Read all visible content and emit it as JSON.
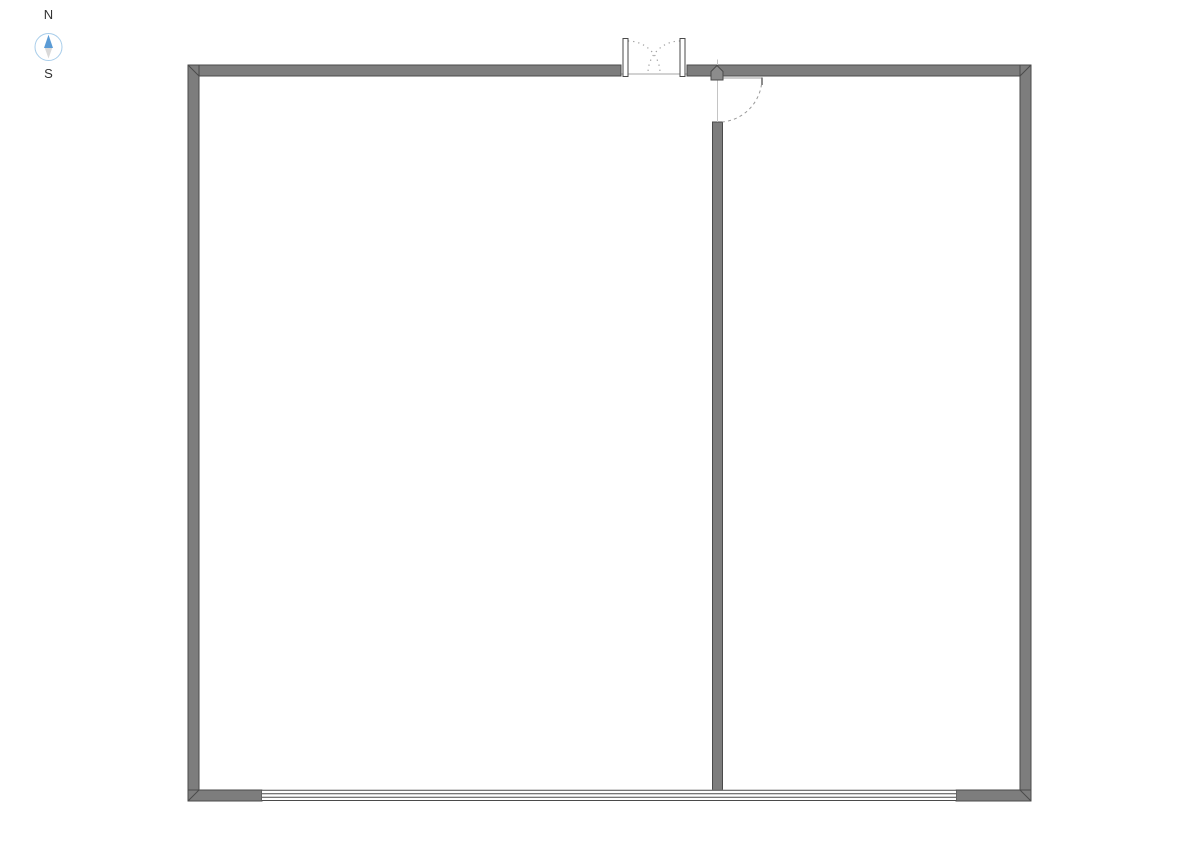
{
  "compass": {
    "north_label": "N",
    "south_label": "S"
  },
  "colors": {
    "background": "#ffffff",
    "wall_fill": "#7d7d7d",
    "wall_outline": "#4a4a4a",
    "window_line": "#4a4a4a",
    "window_fill": "#ffffff",
    "door_panel_fill": "#ffffff",
    "door_swing_dotted": "#9a9a9a",
    "door_leaf_line": "#b0b0b0",
    "threshold_line": "#a6a6a6",
    "hinge_marker_fill": "#8c8c8c",
    "door_tick": "#666666",
    "closed_door_line": "#c4c4c4",
    "compass_ring": "#a8cdea",
    "compass_north": "#5b9bd5",
    "compass_south": "#d9d9d9",
    "label_color": "#333333"
  }
}
